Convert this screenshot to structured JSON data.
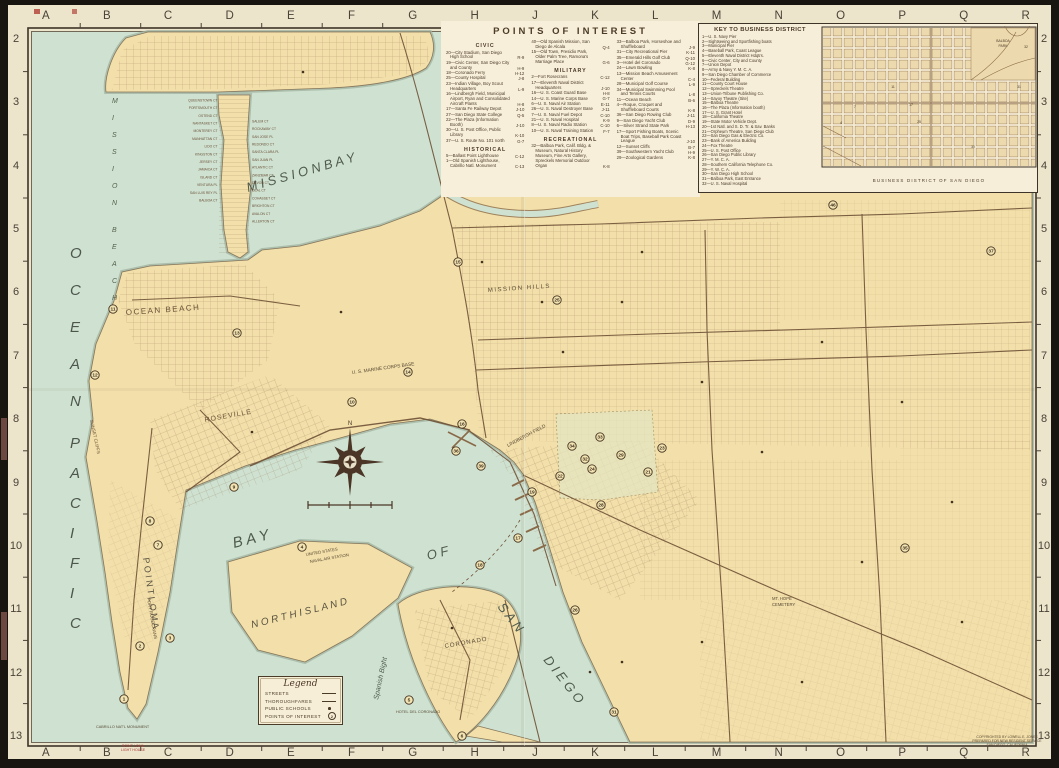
{
  "grid": {
    "columns": [
      "A",
      "B",
      "C",
      "D",
      "E",
      "F",
      "G",
      "H",
      "J",
      "K",
      "L",
      "M",
      "N",
      "O",
      "P",
      "Q",
      "R"
    ],
    "rows": [
      "2",
      "3",
      "4",
      "5",
      "6",
      "7",
      "8",
      "9",
      "10",
      "11",
      "12",
      "13"
    ]
  },
  "page": {
    "corner_note_lines": "POINT LOMA\nLIGHT HOUSE",
    "copyright_lines": "COPYRIGHTED BY LOWELL E. JONES\nPREPARED FOR NEW RESIDENT SERVICE\nSAN DIEGO, CALIFORNIA"
  },
  "poi_box": {
    "title": "POINTS OF INTEREST",
    "columns": [
      [
        {
          "h": "CIVIC"
        },
        {
          "t": "20—City Stadium, San Diego High School",
          "c": "R-9"
        },
        {
          "t": "19—Civic Center, San Diego City and County",
          "c": "H-9"
        },
        {
          "t": "18—Coronado Ferry",
          "c": "H-12"
        },
        {
          "t": "25—County Hospital",
          "c": "J-8"
        },
        {
          "t": "23—Indian Village, Boy Scout Headquarters",
          "c": "L-9"
        },
        {
          "t": "16—Lindbergh Field, Municipal Airport, Ryan and Consolidated Aircraft Plants",
          "c": "H-8"
        },
        {
          "t": "17—Santa Fe Railway Depot",
          "c": "J-10"
        },
        {
          "t": "27—San Diego State College",
          "c": "Q-5"
        },
        {
          "t": "22—The Plaza (Information Booth)",
          "c": "J-10"
        },
        {
          "t": "30—U. S. Post Office, Public Library",
          "c": "K-10"
        },
        {
          "t": "37—U. S. Route No. 101 north",
          "c": "G-7"
        },
        {
          "h": "HISTORICAL"
        },
        {
          "t": "5—Ballast Point Lighthouse",
          "c": "C-12"
        },
        {
          "t": "1—Old Spanish Lighthouse, Cabrillo Natl. Monument",
          "c": "C-13"
        }
      ],
      [
        {
          "t": "40—Old Spanish Mission, San Diego de Alcala",
          "c": "Q-4"
        },
        {
          "t": "15—Old Town, Presidio Park, Older Palm Tree, Ramona's Marriage Place",
          "c": "G-6"
        },
        {
          "h": "MILITARY"
        },
        {
          "t": "2—Fort Rosecrans",
          "c": "C-12"
        },
        {
          "t": "17—Eleventh Naval District Headquarters",
          "c": "J-10"
        },
        {
          "t": "16—U. S. Coast Guard Base",
          "c": "H-8"
        },
        {
          "t": "14—U. S. Marine Corps Base",
          "c": "G-7"
        },
        {
          "t": "6—U. S. Naval Air Station",
          "c": "E-11"
        },
        {
          "t": "26—U. S. Naval Destroyer Base",
          "c": "J-11"
        },
        {
          "t": "7—U. S. Naval Fuel Depot",
          "c": "C-10"
        },
        {
          "t": "21—U. S. Naval Hospital",
          "c": "K-9"
        },
        {
          "t": "8—U. S. Naval Radio Station",
          "c": "C-10"
        },
        {
          "t": "10—U. S. Naval Training Station",
          "c": "F-7"
        },
        {
          "h": "RECREATIONAL"
        },
        {
          "t": "32—Balboa Park, Calif. Bldg. & Museum, Natural History Museum, Fine Arts Gallery, Spreckels Memorial Outdoor Organ",
          "c": "K-8"
        }
      ],
      [
        {
          "t": "33—Balboa Park, Horseshoe and Shuffleboard",
          "c": "J-9"
        },
        {
          "t": "31—City Recreational Pier",
          "c": "K-11"
        },
        {
          "t": "35—Emerald Hills Golf Club",
          "c": "Q-10"
        },
        {
          "t": "3—Hotel del Coronado",
          "c": "G-12"
        },
        {
          "t": "24—Lawn Bowling",
          "c": "K-8"
        },
        {
          "t": "13—Mission Beach Amusement Center",
          "c": "C-4"
        },
        {
          "t": "28—Municipal Golf Course",
          "c": "L-9"
        },
        {
          "t": "34—Municipal Swimming Pool and Tennis Courts",
          "c": "L-8"
        },
        {
          "t": "11—Ocean Beach",
          "c": "B-6"
        },
        {
          "t": "4—Roque, Croquet and Shuffleboard Courts",
          "c": "K-8"
        },
        {
          "t": "36—San Diego Rowing Club",
          "c": "J-11"
        },
        {
          "t": "9—San Diego Yacht Club",
          "c": "D-9"
        },
        {
          "t": "6—Silver Strand State Park",
          "c": "H-13"
        },
        {
          "t": "17—Sport Fishing Boats, Scenic Boat Trips, Baseball Park Coast League",
          "c": "J-10"
        },
        {
          "t": "12—Sunset Cliffs",
          "c": "B-7"
        },
        {
          "t": "39—Southwestern Yacht Club",
          "c": "H-9"
        },
        {
          "t": "29—Zoological Gardens",
          "c": "K-8"
        }
      ]
    ]
  },
  "key_box": {
    "title": "KEY TO BUSINESS DISTRICT",
    "items": [
      "1—U. S. Navy Pier",
      "2—Sightseeing and Sportfishing boats",
      "3—Municipal Pier",
      "4—Baseball Park, Coast League",
      "5—Eleventh Naval District Hdqtrs.",
      "6—Civic Center, City and County",
      "7—Union Depot",
      "8—Army & Navy Y. M. C. A.",
      "9—San Diego Chamber of Commerce",
      "10—Federal Building",
      "11—County Court House",
      "12—Spreckels Theatre",
      "13—Union-Tribune Publishing Co.",
      "14—Savoy Theatre (Site)",
      "15—Balboa Theatre",
      "16—The Plaza (Information booth)",
      "17—U. S. Grant Hotel",
      "18—California Theatre",
      "19—State Motor Vehicle Dept.",
      "20—1st Natl. and S. D. Tr. & Sav. Banks",
      "21—Orpheum Theatre, San Diego Club",
      "22—San Diego Gas & Electric Co.",
      "23—Bank of America Building",
      "24—Fox Theatre",
      "25—U. S. Post Office",
      "26—San Diego Public Library",
      "27—Y. M. C. A.",
      "28—Southern California Telephone Co.",
      "29—Y. W. C. A.",
      "30—San Diego High School",
      "31—Balboa Park, East Entrance",
      "32—U. S. Naval Hospital"
    ],
    "grid_labels": [
      {
        "t": "4",
        "x": 20,
        "y": 98
      },
      {
        "t": "7",
        "x": 34,
        "y": 82
      },
      {
        "t": "11",
        "x": 72,
        "y": 62
      },
      {
        "t": "17",
        "x": 90,
        "y": 80
      },
      {
        "t": "25",
        "x": 98,
        "y": 97
      },
      {
        "t": "30",
        "x": 152,
        "y": 122
      },
      {
        "t": "31",
        "x": 198,
        "y": 62
      },
      {
        "t": "32",
        "x": 205,
        "y": 22
      }
    ],
    "park_label_1": "BALBOA",
    "park_label_2": "PARK",
    "caption": "BUSINESS DISTRICT OF SAN DIEGO"
  },
  "legend_box": {
    "title": "Legend",
    "rows": [
      {
        "label": "STREETS",
        "sym": "thin"
      },
      {
        "label": "THOROUGHFARES",
        "sym": "thick"
      },
      {
        "label": "PUBLIC SCHOOLS",
        "sym": "dot"
      },
      {
        "label": "POINTS OF INTEREST",
        "sym": "circ",
        "mark": "2"
      }
    ]
  },
  "map": {
    "labels": {
      "pacific": "PACIFIC",
      "ocean": "OCEAN",
      "mission_beach": "MISSION BEACH",
      "mission_bay": "M I S S I O N   B A Y",
      "ocean_beach": "OCEAN BEACH",
      "roseville": "ROSEVILLE",
      "point_loma": "P O I N T   L O M A",
      "sunset_cliffs": "SUNSET CLIFFS",
      "fort_rosecrans": "FORT ROSECRANS",
      "cabrillo": "CABRILLO NAT'L MONUMENT",
      "bay": "B A Y",
      "of": "O F",
      "san": "S A N",
      "diego": "D I E G O",
      "north_island": "N O R T H   I S L A N D",
      "spanish_bight": "Spanish Bight",
      "coronado": "CORONADO",
      "hotel_del": "HOTEL DEL CORONADO",
      "naval_air_1": "UNITED STATES",
      "naval_air_2": "NAVAL AIR STATION",
      "marine_base": "U. S. MARINE CORPS BASE",
      "lindbergh": "LINDBERGH FIELD",
      "mission_hills": "MISSION HILLS",
      "mt_hope_1": "MT. HOPE",
      "mt_hope_2": "CEMETERY",
      "compass_n": "N"
    },
    "court_names_west": "QUEENSTOWN CT\nPORTSMOUTH CT\nOSTEND CT\nNANTASKET CT\nMONTEREY CT\nMANHATTAN CT\nLIDO CT\nKINGSTON CT\nJERSEY CT\nJAMAICA CT\nISLAND CT\nVENTURA PL\nSAN LUIS REY PL\nBALBOA CT",
    "court_names_east": "SALEM CT\nROCKAWAY CT\nSAN JOSE PL\nREDONDO CT\nSANTA CLARA PL\nSAN JUAN PL\nATLANTIC CT\nZANZIBAR CT\nDEVON CT\nDEAL CT\nCOHASSET CT\nBRIGHTON CT\nAVALON CT\nALLERTON CT",
    "markers": [
      {
        "n": "46",
        "x": 833,
        "y": 205
      },
      {
        "n": "37",
        "x": 991,
        "y": 251
      },
      {
        "n": "25",
        "x": 557,
        "y": 300
      },
      {
        "n": "15",
        "x": 458,
        "y": 262
      },
      {
        "n": "13",
        "x": 237,
        "y": 333
      },
      {
        "n": "12",
        "x": 95,
        "y": 375
      },
      {
        "n": "11",
        "x": 113,
        "y": 309
      },
      {
        "n": "14",
        "x": 408,
        "y": 372
      },
      {
        "n": "10",
        "x": 352,
        "y": 402
      },
      {
        "n": "16",
        "x": 462,
        "y": 424
      },
      {
        "n": "36",
        "x": 456,
        "y": 451
      },
      {
        "n": "39",
        "x": 481,
        "y": 466
      },
      {
        "n": "9",
        "x": 234,
        "y": 487
      },
      {
        "n": "4",
        "x": 302,
        "y": 547
      },
      {
        "n": "7",
        "x": 158,
        "y": 545
      },
      {
        "n": "8",
        "x": 150,
        "y": 521
      },
      {
        "n": "2",
        "x": 140,
        "y": 646
      },
      {
        "n": "1",
        "x": 124,
        "y": 699
      },
      {
        "n": "3",
        "x": 170,
        "y": 638
      },
      {
        "n": "5",
        "x": 409,
        "y": 700
      },
      {
        "n": "6",
        "x": 462,
        "y": 736
      },
      {
        "n": "18",
        "x": 480,
        "y": 565
      },
      {
        "n": "17",
        "x": 518,
        "y": 538
      },
      {
        "n": "34",
        "x": 572,
        "y": 446
      },
      {
        "n": "33",
        "x": 600,
        "y": 437
      },
      {
        "n": "29",
        "x": 621,
        "y": 455
      },
      {
        "n": "32",
        "x": 585,
        "y": 459
      },
      {
        "n": "21",
        "x": 648,
        "y": 472
      },
      {
        "n": "28",
        "x": 601,
        "y": 505
      },
      {
        "n": "31",
        "x": 614,
        "y": 712
      },
      {
        "n": "26",
        "x": 575,
        "y": 610
      },
      {
        "n": "35",
        "x": 905,
        "y": 548
      },
      {
        "n": "23",
        "x": 662,
        "y": 448
      },
      {
        "n": "19",
        "x": 532,
        "y": 492
      },
      {
        "n": "24",
        "x": 592,
        "y": 469
      },
      {
        "n": "22",
        "x": 560,
        "y": 476
      }
    ],
    "school_dots": [
      [
        303,
        72
      ],
      [
        341,
        312
      ],
      [
        252,
        432
      ],
      [
        563,
        352
      ],
      [
        622,
        302
      ],
      [
        702,
        382
      ],
      [
        762,
        452
      ],
      [
        822,
        342
      ],
      [
        902,
        402
      ],
      [
        952,
        502
      ],
      [
        702,
        642
      ],
      [
        802,
        682
      ],
      [
        622,
        662
      ],
      [
        542,
        302
      ],
      [
        482,
        262
      ],
      [
        862,
        562
      ],
      [
        962,
        622
      ],
      [
        642,
        252
      ],
      [
        590,
        672
      ],
      [
        452,
        628
      ]
    ]
  }
}
